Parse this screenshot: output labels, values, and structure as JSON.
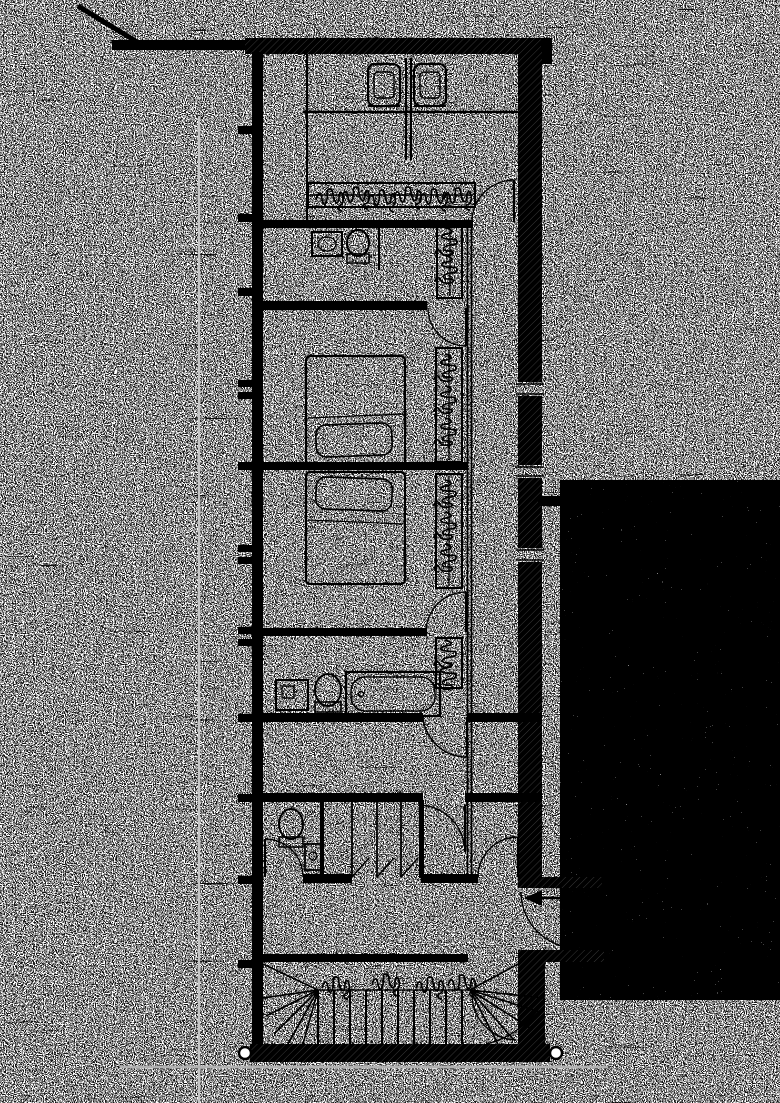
{
  "document": {
    "type": "Scanned architectural floor plan, black ink on white paper with heavy scanner speckle noise",
    "visible_text": "",
    "building_shape": "long narrow plan, rooms stacked vertically, corridor on right side"
  },
  "palette": {
    "ink": "#000000",
    "paper": "#ffffff",
    "crease_line": "#c6c6c6",
    "shadow_line": "#b2b2b2"
  },
  "rooms": [
    {
      "name": "top-room",
      "contents": "two armchairs flanking a central divider, counter line"
    },
    {
      "name": "dressing-room",
      "contents": "hanger rail wardrobe, washbasin, toilet, tall wardrobe"
    },
    {
      "name": "bedroom-1",
      "contents": "double bed with pillow, built-in wardrobe with hangers"
    },
    {
      "name": "bedroom-2",
      "contents": "double bed with pillow, built-in wardrobe with hangers"
    },
    {
      "name": "bathroom",
      "contents": "cabinet, toilet, bathtub, wardrobe"
    },
    {
      "name": "hall",
      "contents": "empty room with door swing"
    },
    {
      "name": "wc-and-stalls",
      "contents": "toilet, basin, three storage stalls with ajar doors"
    },
    {
      "name": "entry-hall",
      "contents": "entrance door with swing arc and entry arrow"
    },
    {
      "name": "stair-hall",
      "contents": "winder staircase with fanned treads at both ends"
    },
    {
      "name": "terrace",
      "contents": "densely stippled paving strip with rounded corner and leader line"
    }
  ],
  "symbols": [
    {
      "name": "glazed-facade-mullions",
      "side": "left"
    },
    {
      "name": "hatched-exterior-walls",
      "style": "solid black poche with hatch ticks"
    },
    {
      "name": "door-swing-arcs",
      "count": 9
    },
    {
      "name": "entrance-arrow",
      "direction": "pointing left into entry hall"
    },
    {
      "name": "hanger-scribbles",
      "meaning": "clothes rails seen from above"
    },
    {
      "name": "column-circles",
      "location": "both ends of bottom wall"
    },
    {
      "name": "crease-line",
      "style": "faint gray vertical scan crease"
    },
    {
      "name": "leader-line",
      "location": "from terrace top corner toward lower right"
    }
  ]
}
